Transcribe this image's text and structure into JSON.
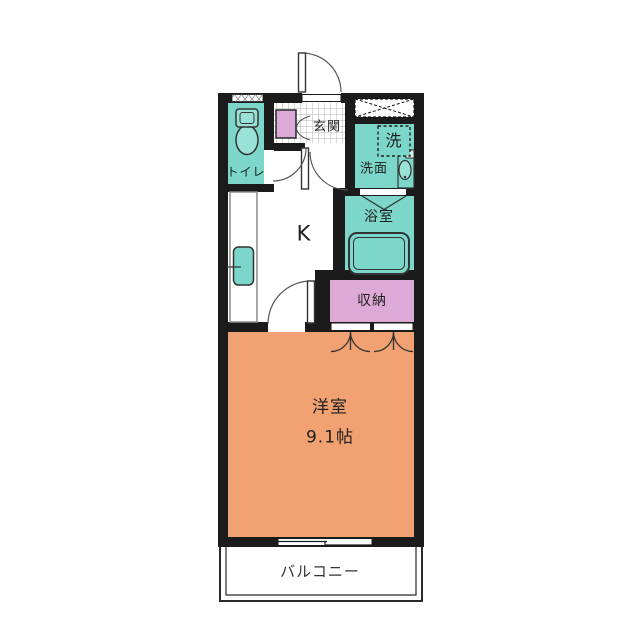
{
  "plan": {
    "title": "1K apartment floor plan",
    "rooms": {
      "toilet": {
        "label": "トイレ"
      },
      "entrance": {
        "label": "玄関"
      },
      "washer": {
        "label": "洗"
      },
      "washroom": {
        "label": "洗面"
      },
      "bathroom": {
        "label": "浴室"
      },
      "kitchen": {
        "label": "K"
      },
      "closet": {
        "label": "収納"
      },
      "western": {
        "label": "洋室",
        "area": "9.1帖"
      },
      "balcony": {
        "label": "バルコニー"
      }
    },
    "colors": {
      "wet_area_teal": "#7CD6CA",
      "fixture_teal": "#9AE2D8",
      "storage_pink": "#DDA9D6",
      "room_orange": "#F1A172",
      "wall_black": "#1B1B1B"
    }
  }
}
